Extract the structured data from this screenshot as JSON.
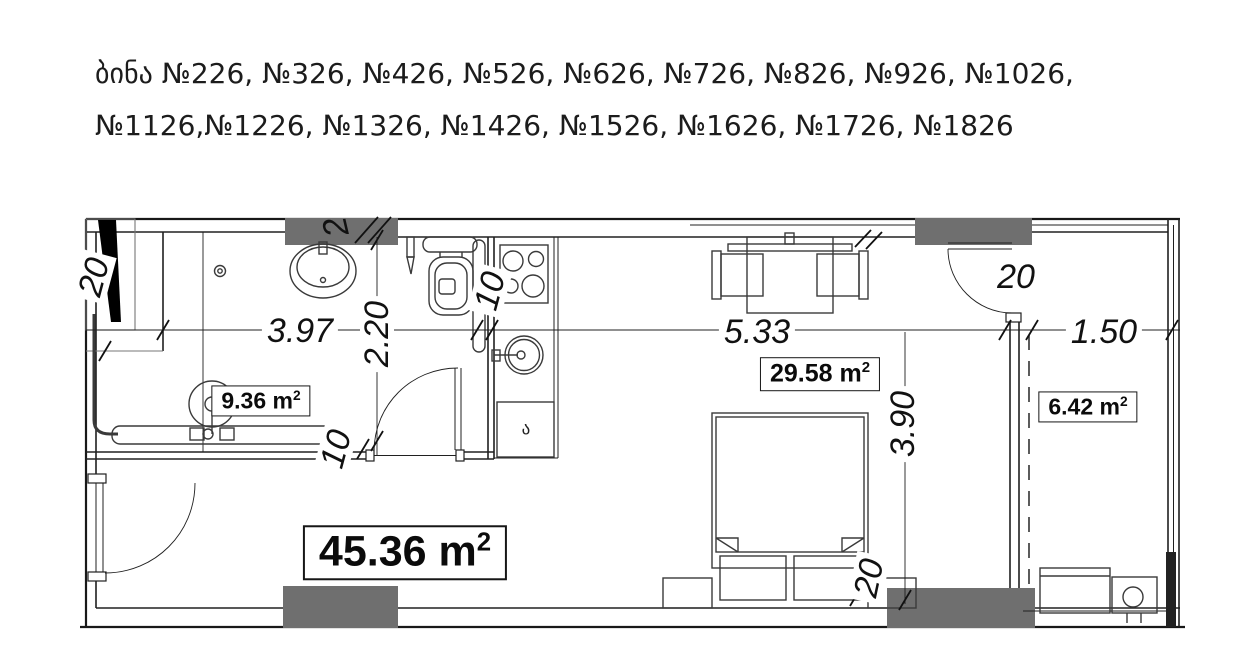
{
  "header": {
    "line1": "ბინა №226, №326, №426, №526, №626, №726, №826, №926, №1026,",
    "line2": "№1126,№1226, №1326, №1426, №1526, №1626, №1726, №1826"
  },
  "plan": {
    "dimensions": {
      "bathroom_width": "3.97",
      "bathroom_depth": "2.20",
      "bedroom_width": "5.33",
      "bedroom_depth": "3.90",
      "balcony_width": "1.50",
      "shaft_wall": "20",
      "bath_wall_thickness": "10",
      "kitchen_wall_thickness": "10",
      "balcony_door_wall": "20",
      "bed_side_gap": "20",
      "column_mark": "2"
    },
    "areas": {
      "bathroom": {
        "value": "9.36 m",
        "sup": "2"
      },
      "bedroom": {
        "value": "29.58 m",
        "sup": "2"
      },
      "balcony": {
        "value": "6.42 m",
        "sup": "2"
      },
      "total": {
        "value": "45.36 m",
        "sup": "2"
      }
    },
    "kitchen_cabinet_label": "ა"
  },
  "colors": {
    "line": "#1a1a1a",
    "column": "#6f6f6f",
    "background": "#ffffff"
  }
}
